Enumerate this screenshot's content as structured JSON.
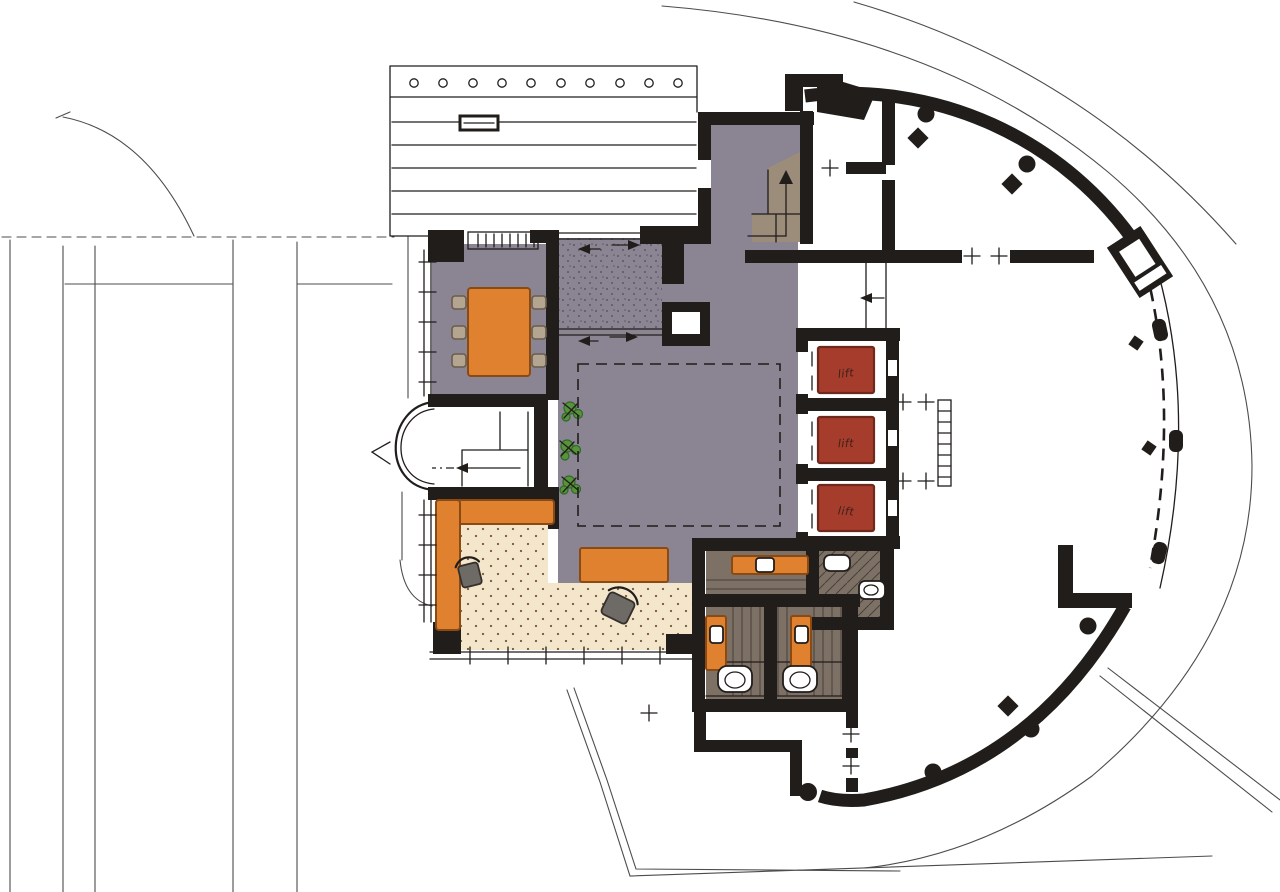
{
  "drawing": {
    "kind": "hand-drawn architectural ground floor plan",
    "lifts": [
      {
        "label": "lift"
      },
      {
        "label": "lift"
      },
      {
        "label": "lift"
      }
    ]
  },
  "colors": {
    "paper": "#ffffff",
    "ink": "#211d1b",
    "site-line": "#4c4c4c",
    "floor-gray": "#8b8492",
    "carpet-cream": "#f3e6cb",
    "stipple": "#7a5c3e",
    "speckle": "#5d5763",
    "accent-orange": "#e0812f",
    "orange-outline": "#8a4a14",
    "lift-red": "#a63c2c",
    "lift-red-dark": "#6f281c",
    "wood-brown": "#7c7164",
    "wood-line": "#47403a",
    "stair-tan": "#9b8d79",
    "chair-tan": "#b3a590",
    "chair-outline": "#6a5d4c",
    "chair-gray": "#6e6a66",
    "chair-dark": "#35302c",
    "plant-green": "#58923c",
    "plant-green-dark": "#2e6a26",
    "handwriting": "#3b211a"
  }
}
